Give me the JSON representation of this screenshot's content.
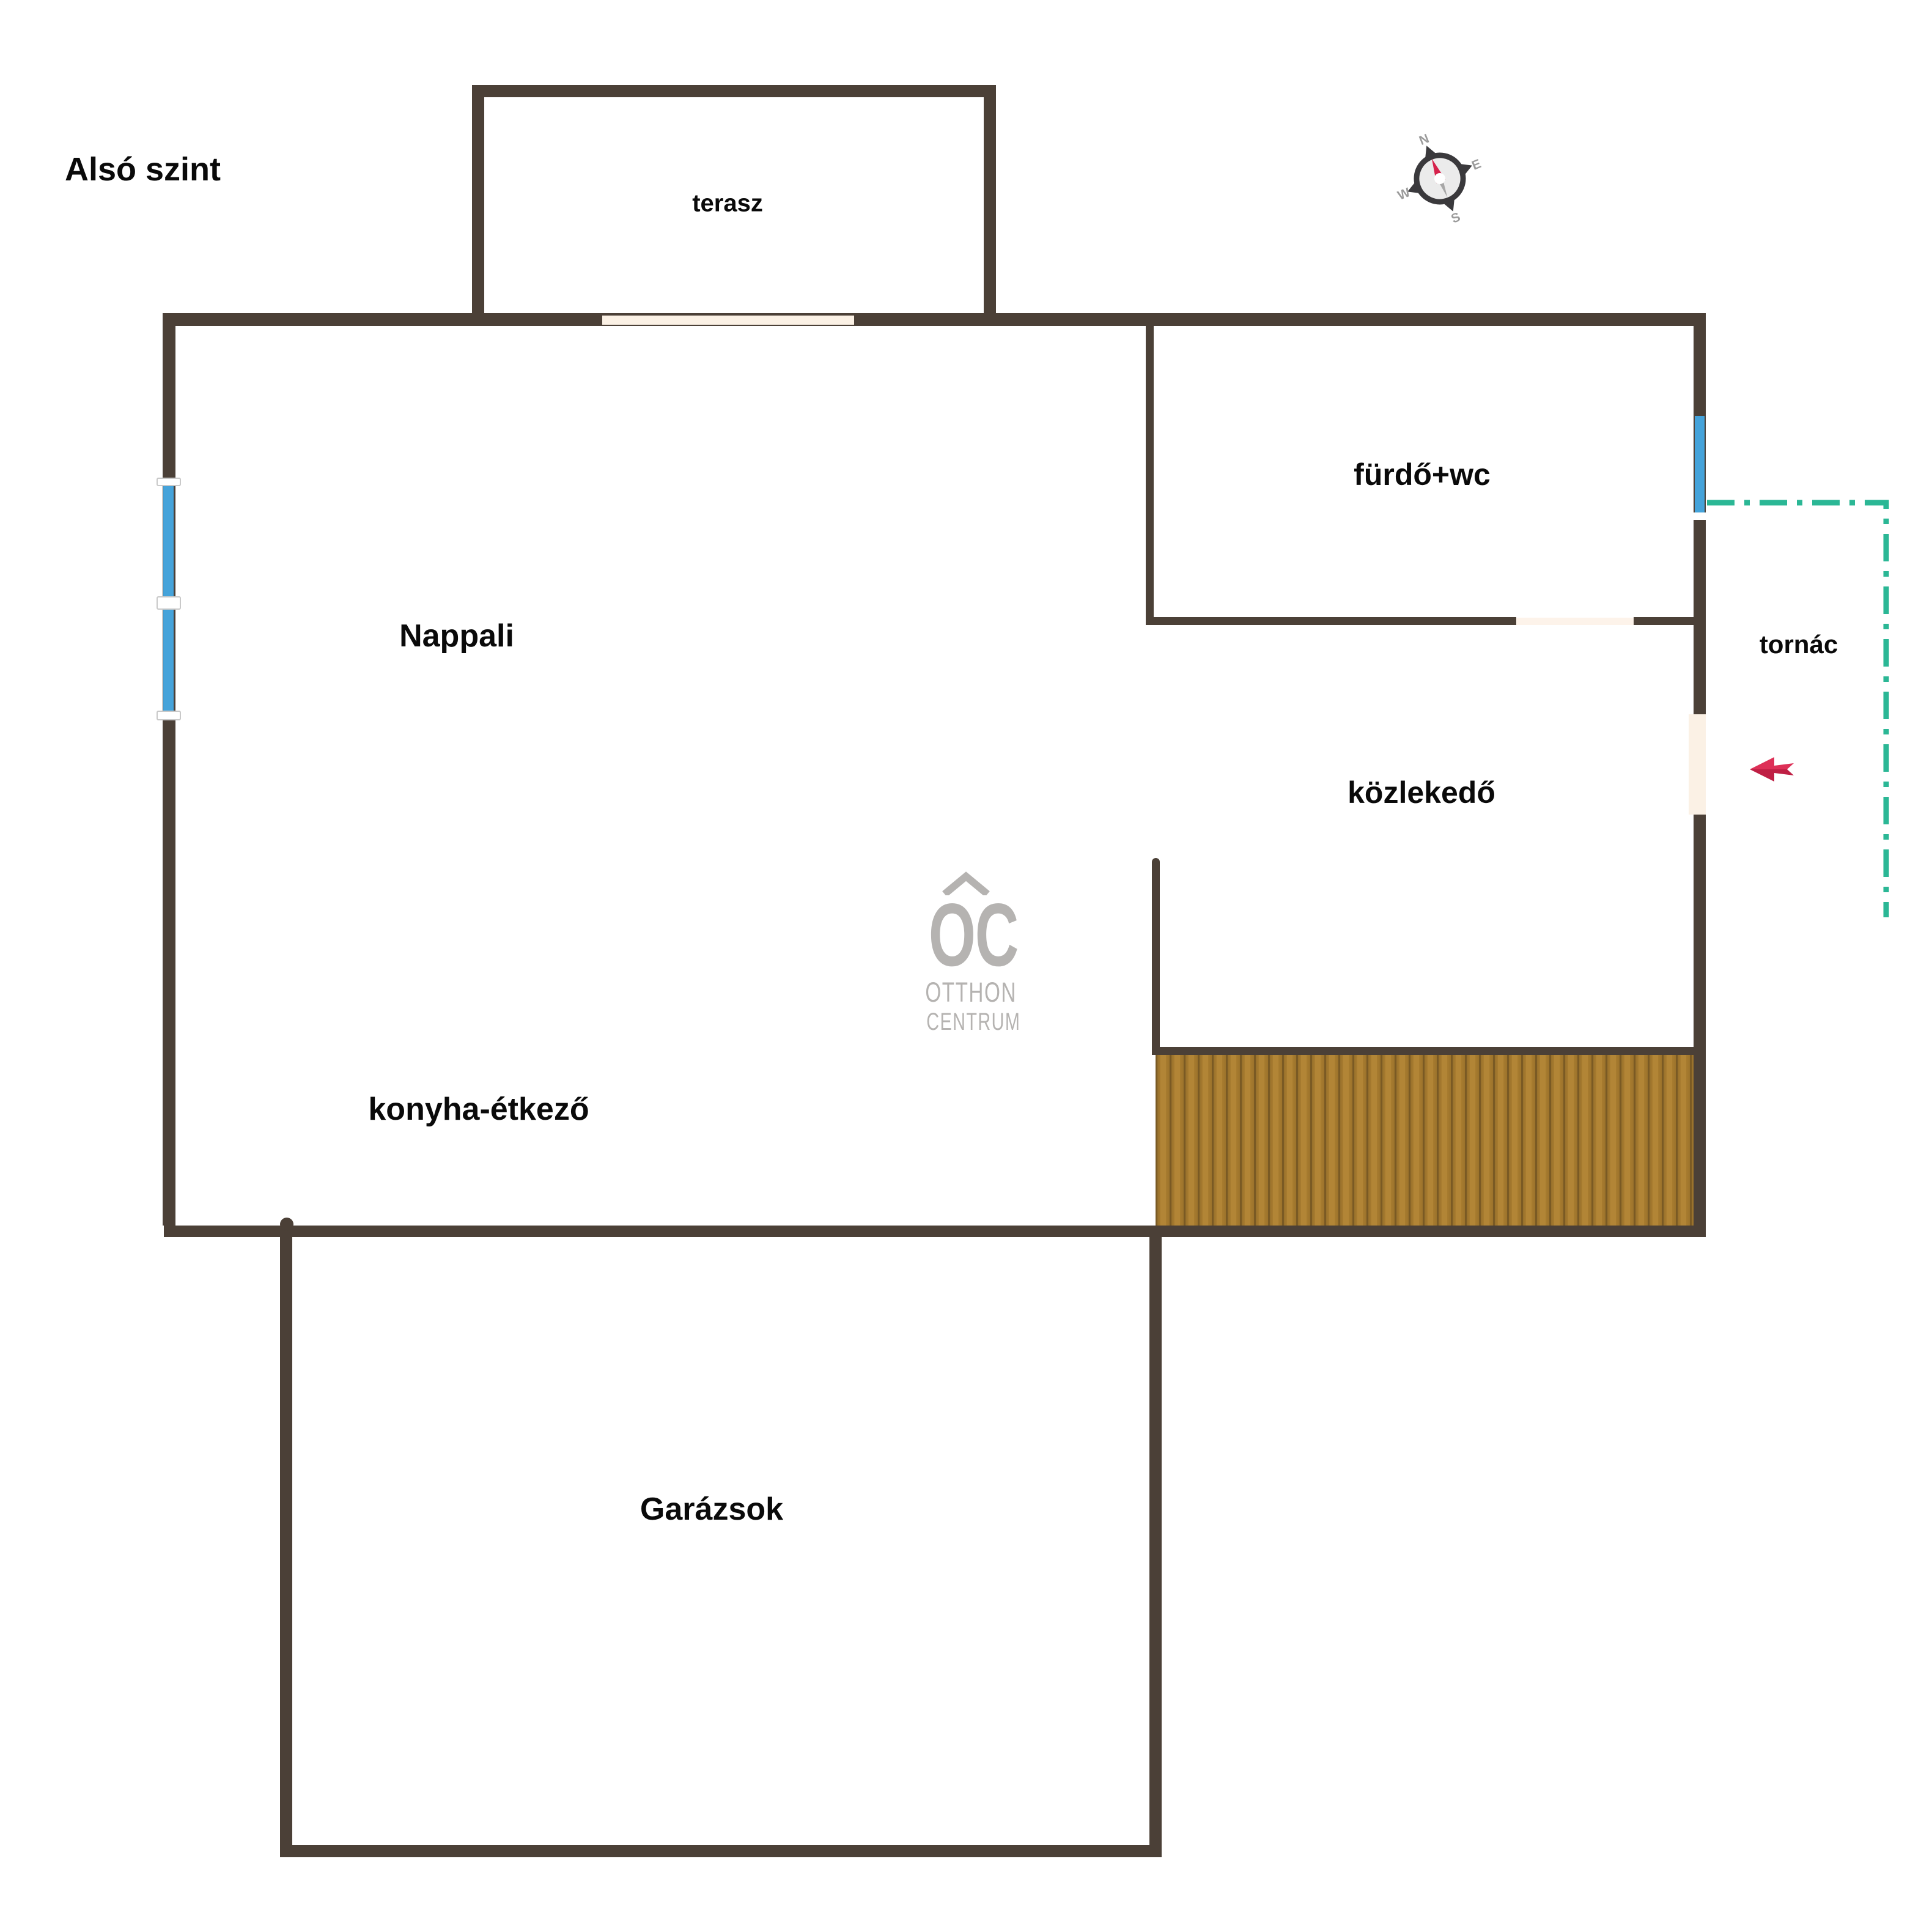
{
  "title": "Alsó szint",
  "rooms": {
    "terasz": "terasz",
    "furdo": "fürdő+wc",
    "tornac": "tornác",
    "kozlekedo": "közlekedő",
    "nappali": "Nappali",
    "konyha": "konyha-étkező",
    "garazs": "Garázsok"
  },
  "compass": {
    "n": "N",
    "e": "E",
    "s": "S",
    "w": "W"
  },
  "logo": {
    "initials": "OC",
    "line1": "OTTHON",
    "line2": "CENTRUM"
  },
  "colors": {
    "wall": "#4b4037",
    "window_blue": "#45a3da",
    "door_cream": "#fbf1e5",
    "porch_teal": "#2bb795",
    "arrow_red_light": "#dd3057",
    "arrow_red_dark": "#bf1f44",
    "deck_light": "#b28536",
    "deck_dark": "#7a5a24",
    "logo_gray": "#b5b3b1",
    "compass_ring": "#3a393c",
    "compass_face": "#ebebeb",
    "compass_letters": "#9b9b9b",
    "compass_needle_red": "#d6224c",
    "compass_needle_gray": "#a7a7a7"
  }
}
